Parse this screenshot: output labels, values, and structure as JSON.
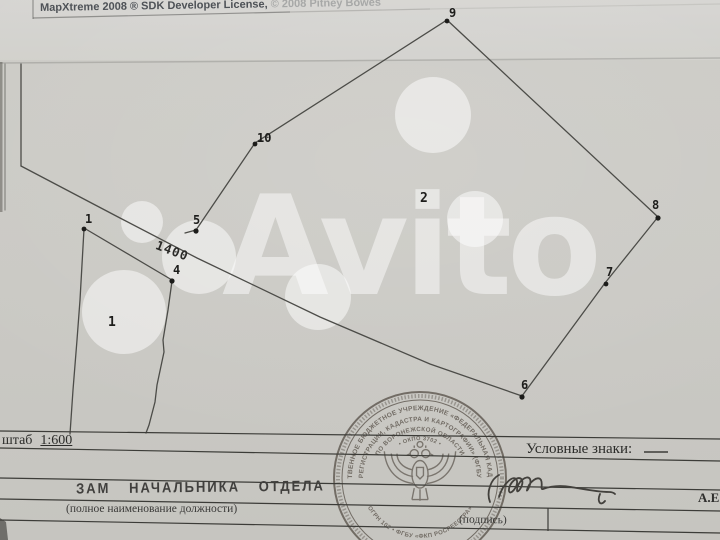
{
  "titlebar": {
    "text_main": "MapXtreme 2008 ® SDK Developer License,",
    "text_faded": " © 2008 Pitney Bowes"
  },
  "watermark": {
    "word": "Avito"
  },
  "map": {
    "parcel2_label": "2",
    "parcel1_label": "1",
    "dimension": "1400",
    "vertices": {
      "v9": "9",
      "v10": "10",
      "v5": "5",
      "v8": "8",
      "v7": "7",
      "v6": "6",
      "v1": "1",
      "v4": "4"
    }
  },
  "footer": {
    "scale_prefix": "штаб",
    "scale_value": "1:600",
    "legend_label": "Условные знаки:",
    "job_title": "ЗАМ  НАЧАЛЬНИКА  ОТДЕЛА",
    "job_caption": "(полное наименование должности)",
    "sign_caption": "(подпись)",
    "initials": "А.Е"
  },
  "stamp": {
    "arc1": "ГОСУДАРСТВЕННОЕ БЮДЖЕТНОЕ УЧРЕЖДЕНИЕ «ФЕДЕРАЛЬНАЯ КАДАСТРОВАЯ",
    "arc2": "РЕГИСТРАЦИИ, КАДАСТРА И КАРТОГРАФИИ» (ФГБУ",
    "arc3": "ПО ВОРОНЕЖСКОЙ ОБЛАСТИ",
    "arc4": "• ОКПО 3702 •",
    "arc_bottom": "ОГРН 102 • ФГБУ «ФКП РОСРЕЕСТРА»"
  }
}
